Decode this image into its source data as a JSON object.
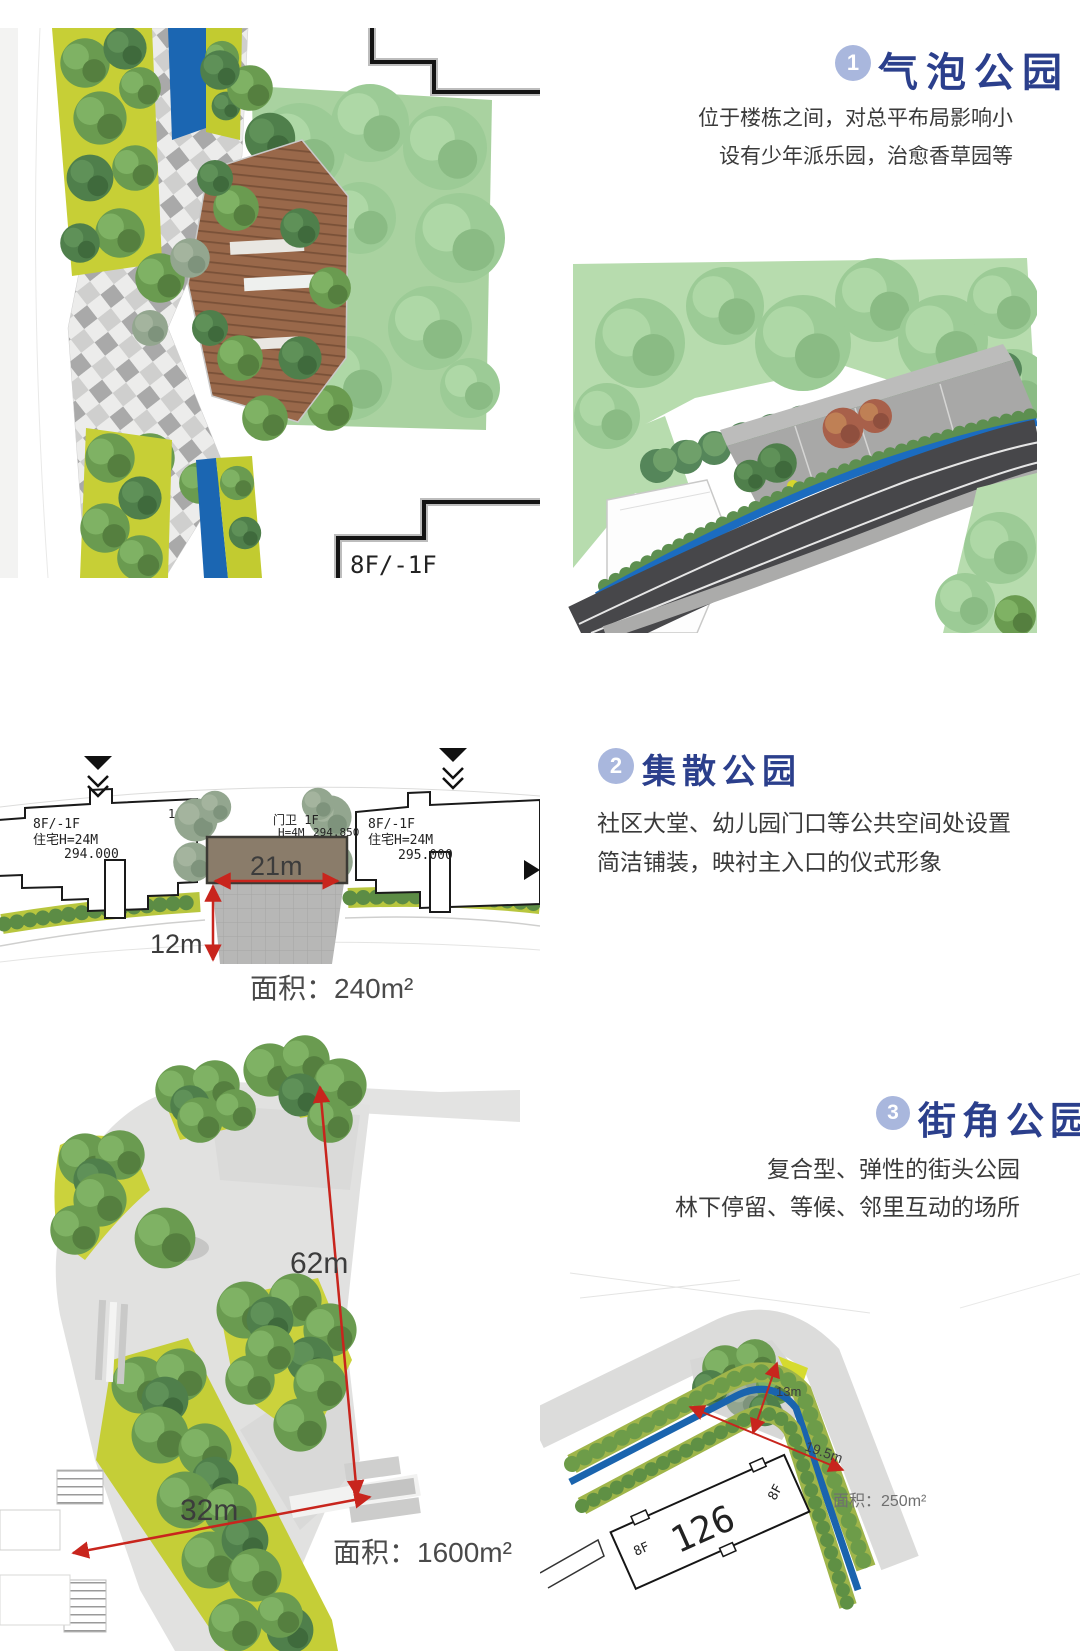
{
  "palette": {
    "heading_blue": "#2b3f8c",
    "badge_blue": "#a9b7dd",
    "dimension_red": "#c8251d",
    "water_blue": "#1b66b2",
    "area_text_gray": "#4a4a4a"
  },
  "section1": {
    "badge": "1",
    "title": "气泡公园",
    "body_line1": "位于楼栋之间，对总平布局影响小",
    "body_line2": "设有少年派乐园，治愈香草园等",
    "plan_floor_label": "8F/-1F"
  },
  "section2": {
    "badge": "2",
    "title": "集散公园",
    "body_line1": "社区大堂、幼儿园门口等公共空间处设置",
    "body_line2": "简洁铺装，映衬主入口的仪式形象",
    "drawing": {
      "left_building": {
        "floors": "8F/-1F",
        "type": "住宅H=24M",
        "elevation": "294.000",
        "tag": "1#楼"
      },
      "gate": {
        "name": "门卫 1F",
        "height": "H=4M",
        "elevation": "294.850"
      },
      "right_building": {
        "floors": "8F/-1F",
        "type": "住宅H=24M",
        "elevation": "295.000"
      },
      "dim_width": "21m",
      "dim_depth": "12m",
      "area": "面积：240m²"
    }
  },
  "section3": {
    "badge": "3",
    "title": "街角公园",
    "body_line1": "复合型、弹性的街头公园",
    "body_line2": "林下停留、等候、邻里互动的场所",
    "large_plan": {
      "dim_long": "62m",
      "dim_short": "32m",
      "area": "面积：1600m²"
    },
    "corner_plan": {
      "dim1": "13m",
      "dim2": "19.5m",
      "area": "面积：250m²",
      "building_no": "126",
      "floor_a": "8F",
      "floor_b": "8F"
    }
  }
}
